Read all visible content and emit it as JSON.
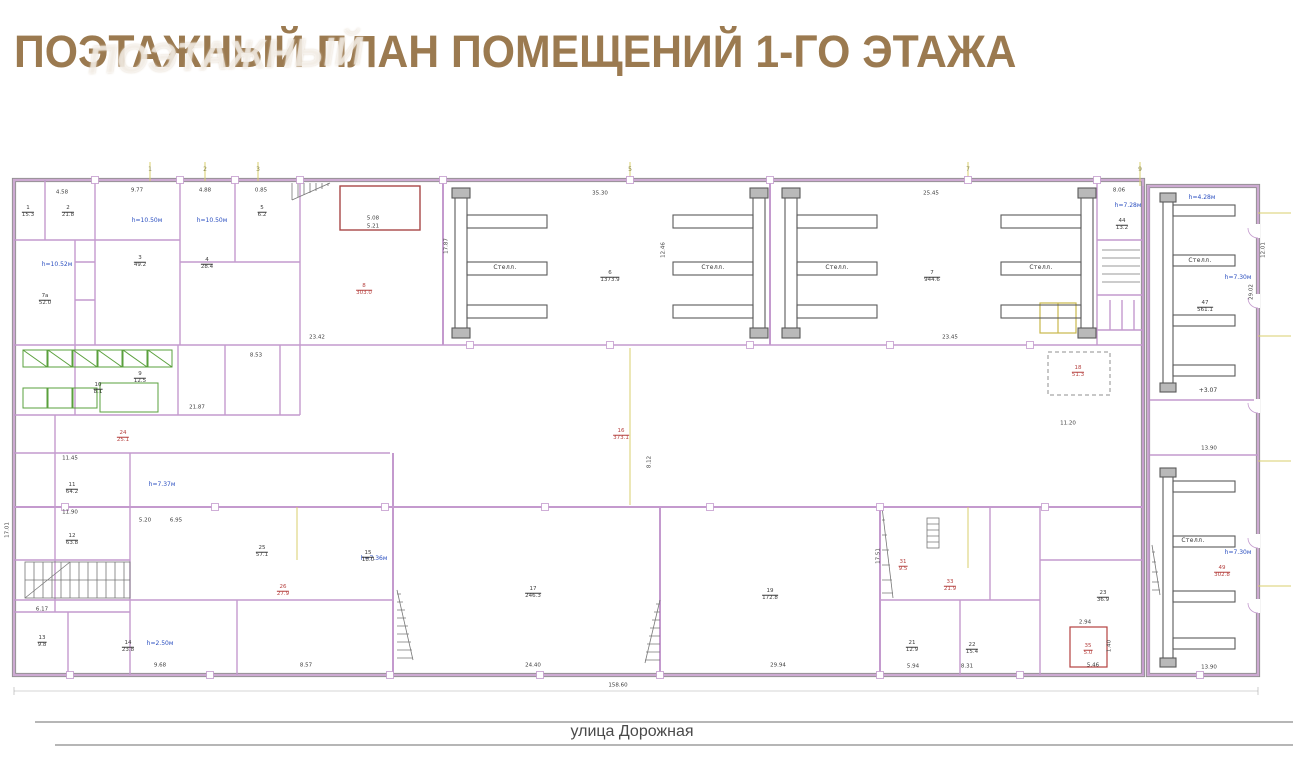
{
  "header": {
    "title": "ПОЭТАЖНЫЙ ПЛАН ПОМЕЩЕНИЙ 1-ГО ЭТАЖА",
    "watermark": "ПОЭТАЖНЫЙ"
  },
  "street": {
    "label": "улица Дорожная"
  },
  "plan": {
    "labels": [
      {
        "type": "dim",
        "text": "4.58",
        "x": 62,
        "y": 193
      },
      {
        "type": "dim",
        "text": "9.77",
        "x": 137,
        "y": 191
      },
      {
        "type": "dim",
        "text": "4.88",
        "x": 205,
        "y": 191
      },
      {
        "type": "dim",
        "text": "0.85",
        "x": 261,
        "y": 191
      },
      {
        "type": "dim",
        "text": "35.30",
        "x": 600,
        "y": 194
      },
      {
        "type": "dim",
        "text": "25.45",
        "x": 931,
        "y": 194
      },
      {
        "type": "dim",
        "text": "8.06",
        "x": 1119,
        "y": 191
      },
      {
        "type": "dim",
        "text": "5.08",
        "x": 373,
        "y": 219
      },
      {
        "type": "dim",
        "text": "5.21",
        "x": 373,
        "y": 227
      },
      {
        "type": "dim",
        "text": "17.87",
        "x": 447,
        "y": 246,
        "rot": true
      },
      {
        "type": "dim",
        "text": "12.46",
        "x": 664,
        "y": 250,
        "rot": true
      },
      {
        "type": "dim",
        "text": "23.42",
        "x": 317,
        "y": 338
      },
      {
        "type": "dim",
        "text": "23.45",
        "x": 950,
        "y": 338
      },
      {
        "type": "dim",
        "text": "21.87",
        "x": 197,
        "y": 408
      },
      {
        "type": "dim",
        "text": "8.53",
        "x": 256,
        "y": 356
      },
      {
        "type": "dim",
        "text": "11.45",
        "x": 70,
        "y": 459
      },
      {
        "type": "dim",
        "text": "11.90",
        "x": 70,
        "y": 513
      },
      {
        "type": "dim",
        "text": "5.20",
        "x": 145,
        "y": 521
      },
      {
        "type": "dim",
        "text": "6.95",
        "x": 176,
        "y": 521
      },
      {
        "type": "dim",
        "text": "6.17",
        "x": 42,
        "y": 610
      },
      {
        "type": "dim",
        "text": "9.68",
        "x": 160,
        "y": 666
      },
      {
        "type": "dim",
        "text": "8.57",
        "x": 306,
        "y": 666
      },
      {
        "type": "dim",
        "text": "24.40",
        "x": 533,
        "y": 666
      },
      {
        "type": "dim",
        "text": "29.94",
        "x": 778,
        "y": 666
      },
      {
        "type": "dim",
        "text": "5.94",
        "x": 913,
        "y": 667
      },
      {
        "type": "dim",
        "text": "8.31",
        "x": 967,
        "y": 667
      },
      {
        "type": "dim",
        "text": "5.46",
        "x": 1093,
        "y": 666
      },
      {
        "type": "dim",
        "text": "13.90",
        "x": 1209,
        "y": 668
      },
      {
        "type": "dim",
        "text": "13.90",
        "x": 1209,
        "y": 449
      },
      {
        "type": "dim",
        "text": "158.60",
        "x": 618,
        "y": 686
      },
      {
        "type": "dim",
        "text": "17.51",
        "x": 879,
        "y": 556,
        "rot": true
      },
      {
        "type": "dim",
        "text": "11.20",
        "x": 1068,
        "y": 424
      },
      {
        "type": "dim",
        "text": "12.01",
        "x": 1264,
        "y": 250,
        "rot": true
      },
      {
        "type": "dim",
        "text": "29.02",
        "x": 1252,
        "y": 292,
        "rot": true
      },
      {
        "type": "dim",
        "text": "17.01",
        "x": 8,
        "y": 530,
        "rot": true
      },
      {
        "type": "dim",
        "text": "8.12",
        "x": 650,
        "y": 462,
        "rot": true
      },
      {
        "type": "dim",
        "text": "2.94",
        "x": 1085,
        "y": 623
      },
      {
        "type": "dim",
        "text": "1.40",
        "x": 1110,
        "y": 646,
        "rot": true
      },
      {
        "type": "blue",
        "text": "h=10.50м",
        "x": 147,
        "y": 221
      },
      {
        "type": "blue",
        "text": "h=10.50м",
        "x": 212,
        "y": 221
      },
      {
        "type": "blue",
        "text": "h=10.52м",
        "x": 57,
        "y": 265
      },
      {
        "type": "blue",
        "text": "h=7.28м",
        "x": 1128,
        "y": 206
      },
      {
        "type": "blue",
        "text": "h=4.28м",
        "x": 1202,
        "y": 198
      },
      {
        "type": "blue",
        "text": "h=7.37м",
        "x": 162,
        "y": 485
      },
      {
        "type": "blue",
        "text": "h=7.36м",
        "x": 374,
        "y": 559
      },
      {
        "type": "blue",
        "text": "h=2.50м",
        "x": 160,
        "y": 644
      },
      {
        "type": "blue",
        "text": "h=7.30м",
        "x": 1238,
        "y": 278
      },
      {
        "type": "blue",
        "text": "h=7.30м",
        "x": 1238,
        "y": 553
      },
      {
        "type": "redfrac",
        "num": "8",
        "den": "303.0",
        "x": 364,
        "y": 290
      },
      {
        "type": "redfrac",
        "num": "16",
        "den": "373.1",
        "x": 621,
        "y": 435
      },
      {
        "type": "redfrac",
        "num": "18",
        "den": "51.3",
        "x": 1078,
        "y": 372
      },
      {
        "type": "redfrac",
        "num": "24",
        "den": "25.1",
        "x": 123,
        "y": 437
      },
      {
        "type": "redfrac",
        "num": "26",
        "den": "27.9",
        "x": 283,
        "y": 591
      },
      {
        "type": "redfrac",
        "num": "31",
        "den": "9.5",
        "x": 903,
        "y": 566
      },
      {
        "type": "redfrac",
        "num": "33",
        "den": "21.9",
        "x": 950,
        "y": 586
      },
      {
        "type": "redfrac",
        "num": "35",
        "den": "5.0",
        "x": 1088,
        "y": 650
      },
      {
        "type": "redfrac",
        "num": "49",
        "den": "302.8",
        "x": 1222,
        "y": 572
      },
      {
        "type": "frac",
        "num": "1",
        "den": "15.3",
        "x": 28,
        "y": 212
      },
      {
        "type": "frac",
        "num": "2",
        "den": "21.8",
        "x": 68,
        "y": 212
      },
      {
        "type": "frac",
        "num": "3",
        "den": "49.2",
        "x": 140,
        "y": 262
      },
      {
        "type": "frac",
        "num": "4",
        "den": "28.4",
        "x": 207,
        "y": 264
      },
      {
        "type": "frac",
        "num": "5",
        "den": "6.2",
        "x": 262,
        "y": 212
      },
      {
        "type": "frac",
        "num": "6",
        "den": "1373.9",
        "x": 610,
        "y": 277
      },
      {
        "type": "frac",
        "num": "7",
        "den": "944.6",
        "x": 932,
        "y": 277
      },
      {
        "type": "frac",
        "num": "9",
        "den": "12.5",
        "x": 140,
        "y": 378
      },
      {
        "type": "frac",
        "num": "10",
        "den": "8.1",
        "x": 98,
        "y": 389
      },
      {
        "type": "frac",
        "num": "11",
        "den": "64.2",
        "x": 72,
        "y": 489
      },
      {
        "type": "frac",
        "num": "12",
        "den": "63.8",
        "x": 72,
        "y": 540
      },
      {
        "type": "frac",
        "num": "13",
        "den": "9.8",
        "x": 42,
        "y": 642
      },
      {
        "type": "frac",
        "num": "14",
        "den": "23.8",
        "x": 128,
        "y": 647
      },
      {
        "type": "frac",
        "num": "15",
        "den": "18.0",
        "x": 368,
        "y": 557
      },
      {
        "type": "frac",
        "num": "17",
        "den": "246.3",
        "x": 533,
        "y": 593
      },
      {
        "type": "frac",
        "num": "19",
        "den": "172.8",
        "x": 770,
        "y": 595
      },
      {
        "type": "frac",
        "num": "21",
        "den": "12.9",
        "x": 912,
        "y": 647
      },
      {
        "type": "frac",
        "num": "22",
        "den": "15.4",
        "x": 972,
        "y": 649
      },
      {
        "type": "frac",
        "num": "23",
        "den": "36.9",
        "x": 1103,
        "y": 597
      },
      {
        "type": "frac",
        "num": "25",
        "den": "57.1",
        "x": 262,
        "y": 552
      },
      {
        "type": "frac",
        "num": "44",
        "den": "13.2",
        "x": 1122,
        "y": 225
      },
      {
        "type": "frac",
        "num": "47",
        "den": "561.1",
        "x": 1205,
        "y": 307
      },
      {
        "type": "frac",
        "num": "7а",
        "den": "52.0",
        "x": 45,
        "y": 300
      },
      {
        "type": "rack",
        "text": "Стелл.",
        "x": 505,
        "y": 268
      },
      {
        "type": "rack",
        "text": "Стелл.",
        "x": 713,
        "y": 268
      },
      {
        "type": "rack",
        "text": "Стелл.",
        "x": 837,
        "y": 268
      },
      {
        "type": "rack",
        "text": "Стелл.",
        "x": 1041,
        "y": 268
      },
      {
        "type": "rack",
        "text": "Стелл.",
        "x": 1200,
        "y": 261
      },
      {
        "type": "rack",
        "text": "Стелл.",
        "x": 1193,
        "y": 541
      },
      {
        "type": "level",
        "text": "+3.07",
        "x": 1208,
        "y": 391
      },
      {
        "type": "axis",
        "text": "1",
        "x": 150,
        "y": 170
      },
      {
        "type": "axis",
        "text": "2",
        "x": 205,
        "y": 170
      },
      {
        "type": "axis",
        "text": "3",
        "x": 258,
        "y": 170
      },
      {
        "type": "axis",
        "text": "5",
        "x": 630,
        "y": 170
      },
      {
        "type": "axis",
        "text": "7",
        "x": 968,
        "y": 170
      },
      {
        "type": "axis",
        "text": "9",
        "x": 1140,
        "y": 170
      }
    ]
  }
}
